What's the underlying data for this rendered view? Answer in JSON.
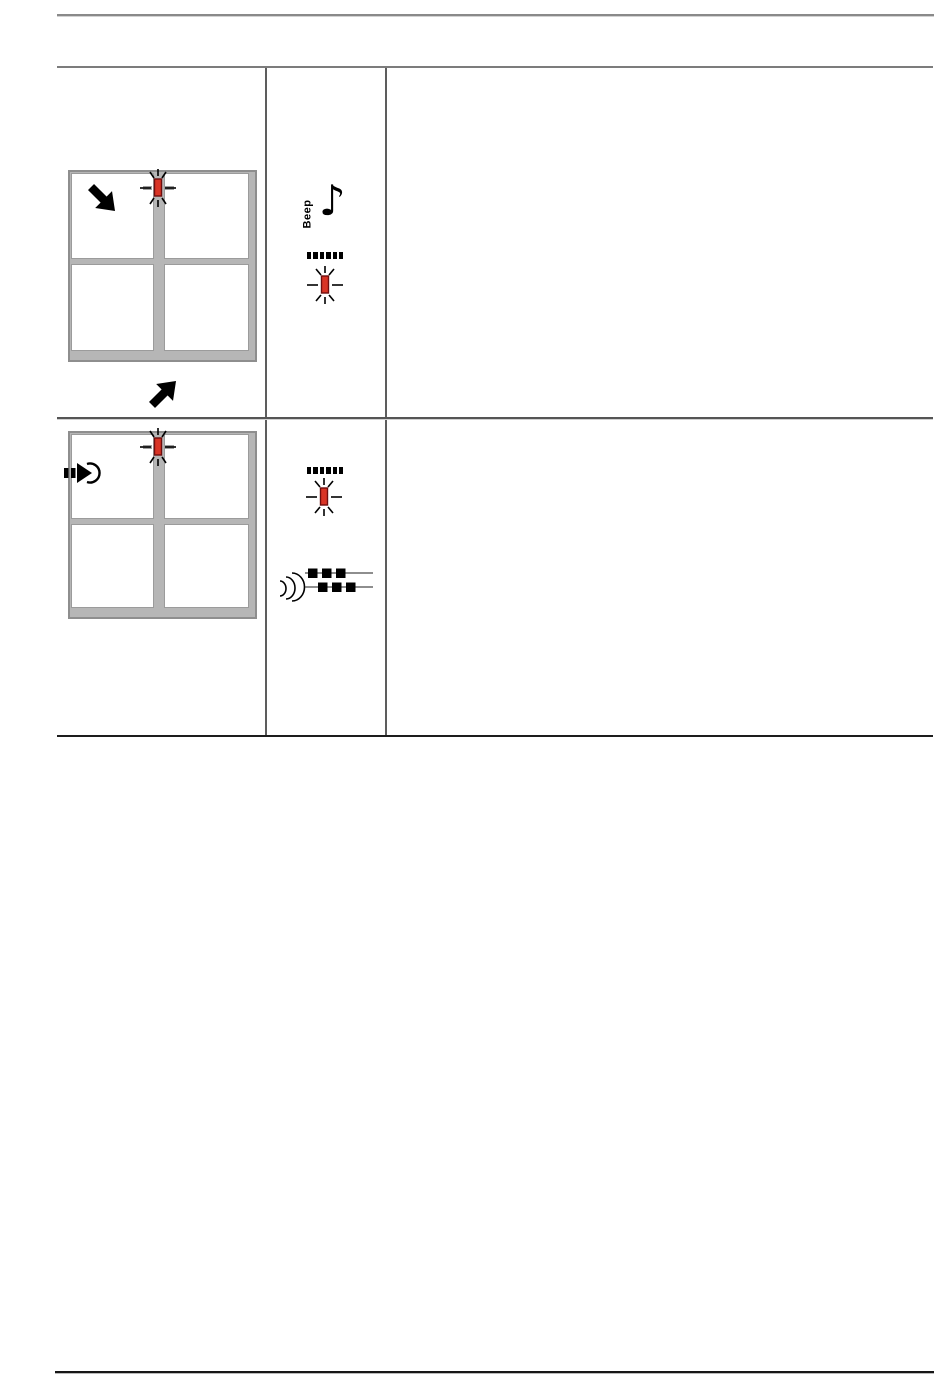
{
  "page": {
    "kind": "manual-troubleshooting-table-page",
    "visible_text": "Beep",
    "background": "#ffffff"
  },
  "colors": {
    "led_red": "#d93425",
    "led_border": "#6e0e0e",
    "device_gray": "#b6b6b6",
    "device_border_gray": "#8e8e8e",
    "table_rule_gray": "#5d5d5d",
    "table_bottom_black": "#1d1d1d",
    "icon_black": "#000000"
  },
  "table": {
    "columns": [
      "diagram",
      "indicators",
      "description"
    ],
    "rows": [
      {
        "diagram": {
          "name": "device-top-view-with-insert-arrows",
          "elements": [
            "arrow-into-device",
            "blinking-red-led-on-center-guide",
            "arrow-under-device"
          ]
        },
        "indicators": [
          {
            "name": "beep-note-icon",
            "label": "Beep"
          },
          {
            "name": "display-dashes-icon"
          },
          {
            "name": "blinking-red-led-icon"
          }
        ],
        "description": ""
      },
      {
        "diagram": {
          "name": "device-top-view-with-feed-icon",
          "elements": [
            "document-feed-handset-icon",
            "blinking-red-led-on-center-guide"
          ]
        },
        "indicators": [
          {
            "name": "display-dashes-icon"
          },
          {
            "name": "blinking-red-led-icon"
          },
          {
            "name": "distinctive-ring-pattern-icon"
          }
        ],
        "description": ""
      }
    ]
  }
}
